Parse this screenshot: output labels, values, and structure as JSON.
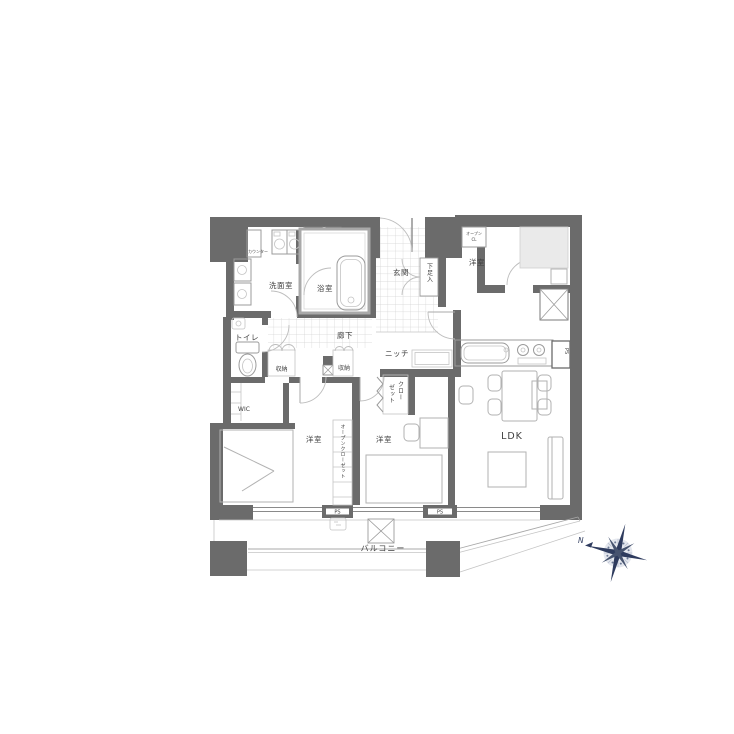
{
  "document": {
    "type": "apartment-floor-plan"
  },
  "colors": {
    "wall": "#6b6b6b",
    "thin_line": "#9b9b9b",
    "tile_grid": "#cfcfcf",
    "light_fill": "#eaeaea",
    "text": "#3f3f3f",
    "compass_navy": "#2e3b5e"
  },
  "labels": {
    "counter": "カウンター",
    "mb": "MB",
    "storage_top": "収納",
    "washroom": "洗面室",
    "bath": "浴室",
    "entrance": "玄関",
    "shoe_cabinet": "下足入",
    "open_cl_line1": "オープン",
    "open_cl_line2": "CL",
    "bedroom_top_right": "洋室",
    "corridor": "廊下",
    "toilet": "トイレ",
    "storage_left": "収納",
    "storage_mid": "収納",
    "niche": "ニッチ",
    "closet_col_right": "クロー",
    "closet_col_left": "ゼット",
    "wic": "WIC",
    "bedroom_bottom_left": "洋室",
    "open_closet": "オープンクローゼット",
    "bedroom_bottom_mid": "洋室",
    "ldk": "LDK",
    "ps_kitchen": "PS",
    "ps_wall_left": "PS",
    "ps_wall_right": "PS",
    "balcony": "バルコニー",
    "north": "N"
  }
}
